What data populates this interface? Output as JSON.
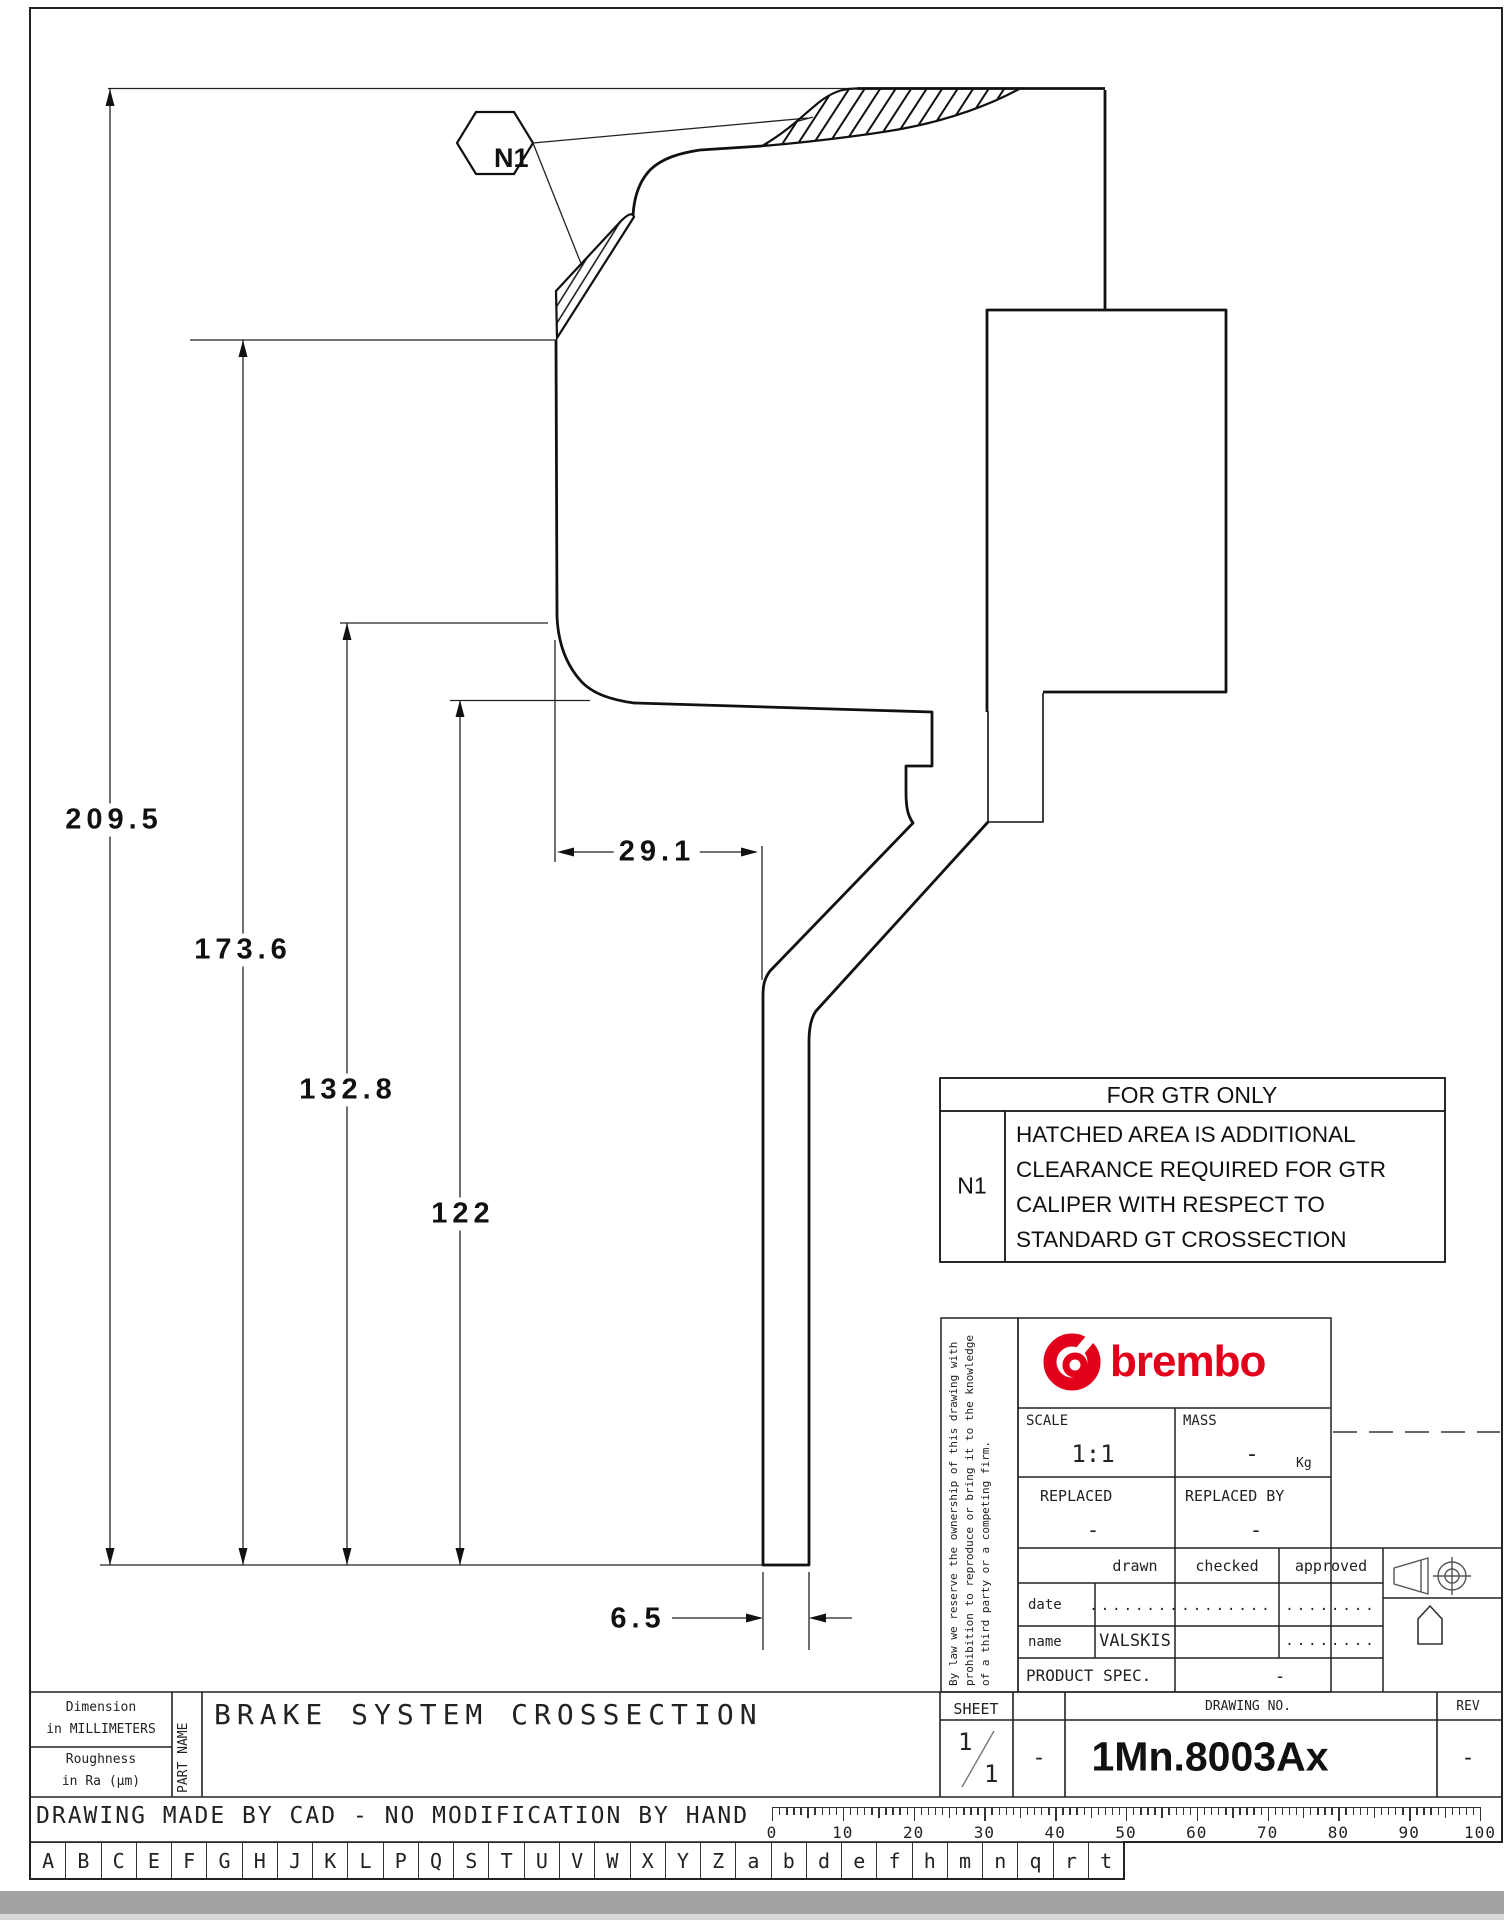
{
  "balloon": {
    "label": "N1"
  },
  "dims": {
    "total_height": "209.5",
    "height_mid": "173.6",
    "height_low": "132.8",
    "height_base": "122",
    "width_top": "29.1",
    "web_thickness": "6.5"
  },
  "note": {
    "title": "FOR GTR ONLY",
    "ref": "N1",
    "lines": [
      "HATCHED AREA IS ADDITIONAL",
      "CLEARANCE REQUIRED FOR GTR",
      "CALIPER WITH RESPECT TO",
      "STANDARD GT CROSSECTION"
    ]
  },
  "title_block": {
    "brand": "brembo",
    "legal": "By law we reserve the ownership of this drawing with prohibition to reproduce or bring it to the knowledge of a third party or a competing firm.",
    "scale_label": "SCALE",
    "scale_value": "1:1",
    "mass_label": "MASS",
    "mass_value": "-",
    "mass_unit": "Kg",
    "replaced_label": "REPLACED",
    "replaced_value": "-",
    "replaced_by_label": "REPLACED BY",
    "replaced_by_value": "-",
    "drawn_label": "drawn",
    "checked_label": "checked",
    "approved_label": "approved",
    "date_label": "date",
    "date_drawn": "........",
    "date_checked": "........",
    "date_approved": "........",
    "name_label": "name",
    "name_drawn": "VALSKIS",
    "name_approved": "........",
    "product_spec_label": "PRODUCT SPEC.",
    "product_spec_value": "-"
  },
  "bottom": {
    "dim_note_1": "Dimension",
    "dim_note_2": "in MILLIMETERS",
    "rough_1": "Roughness",
    "rough_2": "in Ra (μm)",
    "part_name_label": "PART NAME",
    "part_name": "BRAKE SYSTEM CROSSECTION",
    "sheet_label": "SHEET",
    "sheet_num": "1",
    "sheet_den": "1",
    "dash_cell": "-",
    "drawing_no_label": "DRAWING NO.",
    "drawing_no": "1Mn.8003Ax",
    "rev_label": "REV",
    "rev_value": "-",
    "cad_note": "DRAWING MADE BY CAD - NO MODIFICATION BY HAND"
  },
  "ruler": {
    "labels": [
      "0",
      "10",
      "20",
      "30",
      "40",
      "50",
      "60",
      "70",
      "80",
      "90",
      "100"
    ]
  },
  "letters": [
    "A",
    "B",
    "C",
    "E",
    "F",
    "G",
    "H",
    "J",
    "K",
    "L",
    "P",
    "Q",
    "S",
    "T",
    "U",
    "V",
    "W",
    "X",
    "Y",
    "Z",
    "a",
    "b",
    "d",
    "e",
    "f",
    "h",
    "m",
    "n",
    "q",
    "r",
    "t"
  ],
  "colors": {
    "brand_red": "#e2001a",
    "line": "#111111"
  }
}
